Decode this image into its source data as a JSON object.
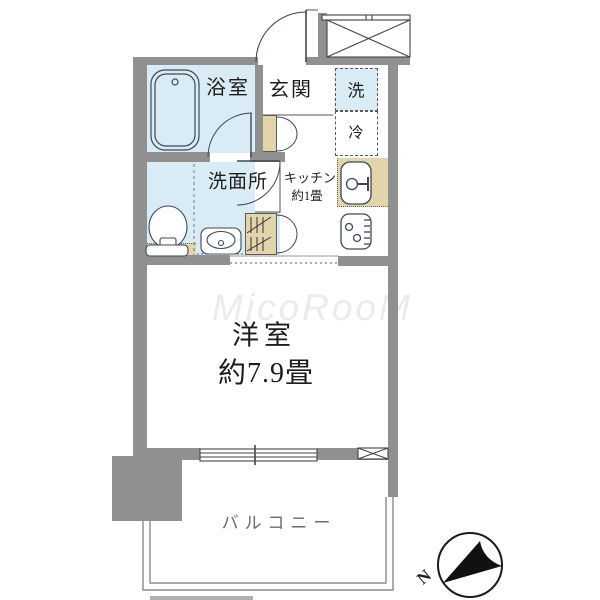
{
  "floorplan": {
    "labels": {
      "bathroom": "浴室",
      "entrance": "玄関",
      "washer": "洗",
      "fridge": "冷",
      "washroom": "洗面所",
      "kitchen": "キッチン",
      "kitchen_size": "約1畳",
      "main_room": "洋室",
      "main_room_size": "約7.9畳",
      "balcony": "バルコニー",
      "compass_n": "N",
      "watermark": "MicoRooM"
    },
    "icons": {
      "bathtub": "bathtub-icon",
      "toilet": "toilet-icon",
      "washbasin": "washbasin-icon",
      "kitchen_sink": "kitchen-sink-icon",
      "stove": "stove-icon",
      "closet_hangers": "hanger-icon",
      "meter_box": "meter-box-icon",
      "compass": "compass-icon"
    },
    "colors": {
      "wall": "#909090",
      "water_area": "#d9ecf6",
      "counter": "#e2d4ab",
      "line": "#3f4656",
      "balcony_text": "#6b6b6b"
    }
  }
}
